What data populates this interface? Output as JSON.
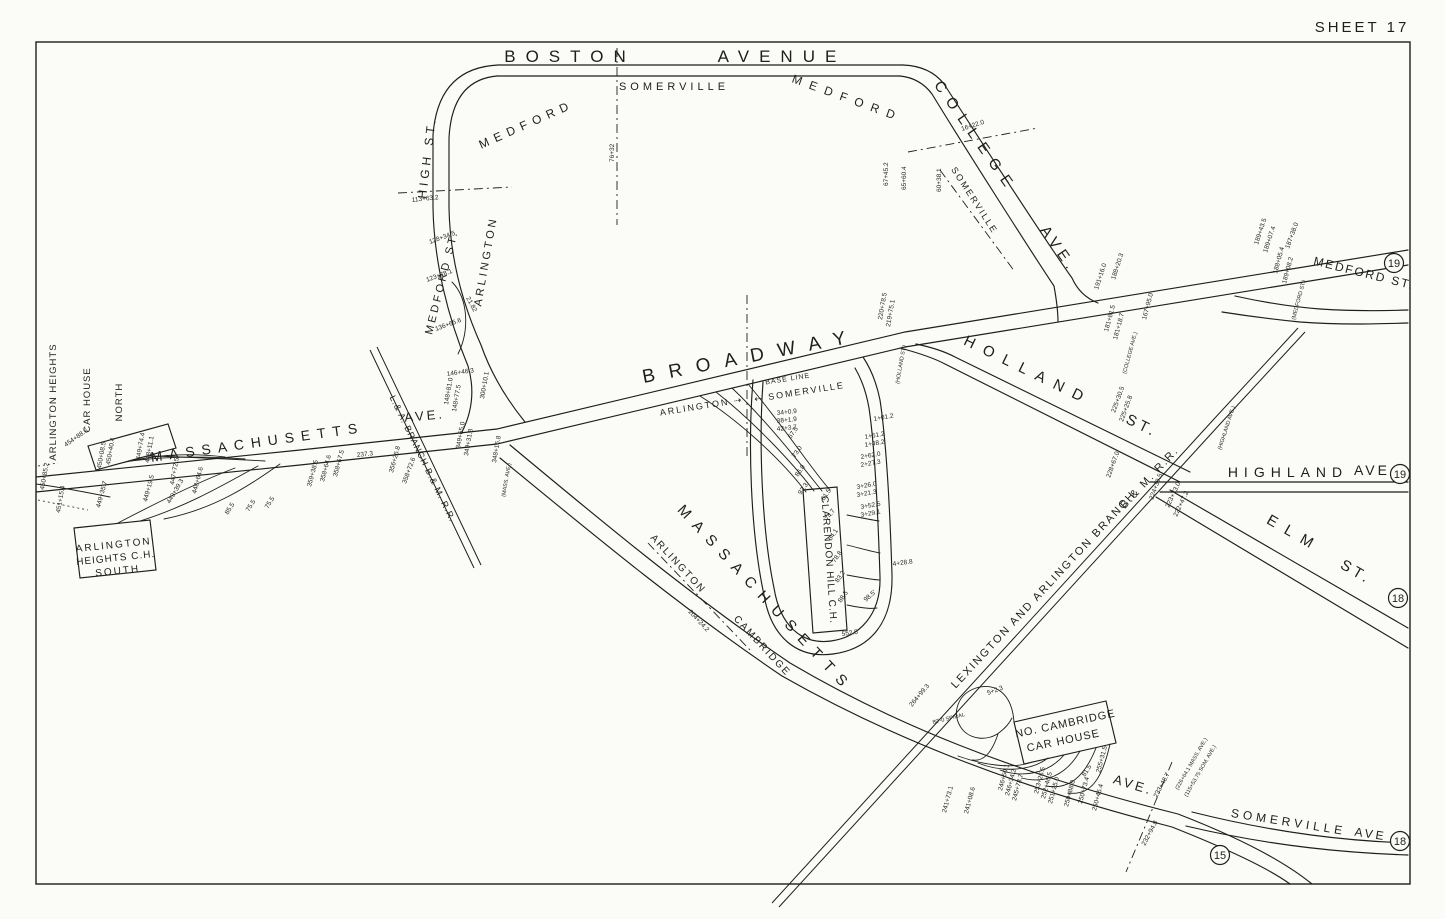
{
  "sheet_title": "SHEET 17",
  "colors": {
    "ink": "#1e1e1e",
    "paper": "#fbfbf8"
  },
  "labels": [
    {
      "n": "street-label-boston",
      "t": "BOSTON",
      "x": 570,
      "y": 62,
      "r": 0,
      "s": 17,
      "ls": 10
    },
    {
      "n": "street-label-avenue",
      "t": "AVENUE",
      "x": 782,
      "y": 62,
      "r": 0,
      "s": 17,
      "ls": 10
    },
    {
      "n": "street-label-college",
      "t": "COLLEGE",
      "x": 972,
      "y": 140,
      "r": 55,
      "s": 15,
      "ls": 9
    },
    {
      "n": "street-label-college-ave",
      "t": "AVE.",
      "x": 1055,
      "y": 252,
      "r": 55,
      "s": 15,
      "ls": 5
    },
    {
      "n": "city-label-medford-west",
      "t": "MEDFORD",
      "x": 528,
      "y": 128,
      "r": -24,
      "s": 12,
      "ls": 6
    },
    {
      "n": "city-label-somerville-top",
      "t": "SOMERVILLE",
      "x": 674,
      "y": 90,
      "r": 0,
      "s": 11,
      "ls": 4
    },
    {
      "n": "city-label-medford-east",
      "t": "MEDFORD",
      "x": 846,
      "y": 102,
      "r": 20,
      "s": 12,
      "ls": 8
    },
    {
      "n": "city-label-somerville-college",
      "t": "SOMERVILLE",
      "x": 972,
      "y": 202,
      "r": 57,
      "s": 9,
      "ls": 2
    },
    {
      "n": "street-label-high-st",
      "t": "HIGH ST.",
      "x": 431,
      "y": 158,
      "r": -83,
      "s": 12,
      "ls": 4
    },
    {
      "n": "street-label-medford-st-arlington",
      "t": "MEDFORD ST.",
      "x": 445,
      "y": 283,
      "r": -76,
      "s": 11,
      "ls": 3
    },
    {
      "n": "city-label-arlington",
      "t": "ARLINGTON",
      "x": 489,
      "y": 262,
      "r": -80,
      "s": 11,
      "ls": 3
    },
    {
      "n": "street-label-broadway",
      "t": "BROADWAY",
      "x": 752,
      "y": 362,
      "r": -11,
      "s": 19,
      "ls": 14
    },
    {
      "n": "boundary-label-arlington",
      "t": "ARLINGTON ⇢",
      "x": 702,
      "y": 409,
      "r": -9,
      "s": 9,
      "ls": 2
    },
    {
      "n": "boundary-label-somerville",
      "t": "⇠ SOMERVILLE",
      "x": 800,
      "y": 395,
      "r": -9,
      "s": 9,
      "ls": 2
    },
    {
      "n": "note-label-base-line",
      "t": "BASE LINE",
      "x": 788,
      "y": 381,
      "r": -9,
      "s": 7,
      "ls": 1
    },
    {
      "n": "street-label-holland",
      "t": "HOLLAND",
      "x": 1026,
      "y": 375,
      "r": 26,
      "s": 15,
      "ls": 10
    },
    {
      "n": "street-label-holland-st",
      "t": "ST.",
      "x": 1140,
      "y": 430,
      "r": 26,
      "s": 15,
      "ls": 4
    },
    {
      "n": "street-label-highland",
      "t": "HIGHLAND",
      "x": 1288,
      "y": 477,
      "r": 0,
      "s": 14,
      "ls": 6
    },
    {
      "n": "street-label-highland-ave",
      "t": "AVE",
      "x": 1372,
      "y": 475,
      "r": 0,
      "s": 14,
      "ls": 3
    },
    {
      "n": "street-label-elm",
      "t": "ELM",
      "x": 1292,
      "y": 538,
      "r": 30,
      "s": 15,
      "ls": 10
    },
    {
      "n": "street-label-elm-st",
      "t": "ST.",
      "x": 1354,
      "y": 576,
      "r": 30,
      "s": 15,
      "ls": 4
    },
    {
      "n": "street-label-medford-st-east",
      "t": "MEDFORD ST.",
      "x": 1363,
      "y": 277,
      "r": 14,
      "s": 12,
      "ls": 2
    },
    {
      "n": "street-label-massachusetts-west",
      "t": "MASSACHUSETTS",
      "x": 258,
      "y": 447,
      "r": -8,
      "s": 14,
      "ls": 7
    },
    {
      "n": "street-label-ave-west",
      "t": "AVE.",
      "x": 425,
      "y": 420,
      "r": -5,
      "s": 13,
      "ls": 3
    },
    {
      "n": "street-label-massachusetts-south",
      "t": "MASSACHUSETTS",
      "x": 762,
      "y": 602,
      "r": 47,
      "s": 15,
      "ls": 9
    },
    {
      "n": "street-label-ave-south",
      "t": "AVE.",
      "x": 1132,
      "y": 789,
      "r": 17,
      "s": 13,
      "ls": 3
    },
    {
      "n": "boundary-label-arlington-south",
      "t": "ARLINGTON",
      "x": 676,
      "y": 566,
      "r": 47,
      "s": 10,
      "ls": 2
    },
    {
      "n": "boundary-label-cambridge",
      "t": "CAMBRIDGE",
      "x": 760,
      "y": 648,
      "r": 47,
      "s": 10,
      "ls": 2
    },
    {
      "n": "street-label-somerville-ave",
      "t": "SOMERVILLE",
      "x": 1288,
      "y": 826,
      "r": 9,
      "s": 12,
      "ls": 4
    },
    {
      "n": "street-label-somerville-ave2",
      "t": "AVE",
      "x": 1370,
      "y": 838,
      "r": 9,
      "s": 12,
      "ls": 3
    },
    {
      "n": "railroad-label-lexington-branch",
      "t": "LEXINGTON AND ARLINGTON BRANCH",
      "x": 1046,
      "y": 592,
      "r": -47,
      "s": 11,
      "ls": 2
    },
    {
      "n": "railroad-label-bm-rr",
      "t": "B.& M. R.R.",
      "x": 1152,
      "y": 480,
      "r": -47,
      "s": 11,
      "ls": 2
    },
    {
      "n": "railroad-label-la-branch",
      "t": "L.& A. BRANCH B.& M. R.R.",
      "x": 420,
      "y": 460,
      "r": 64,
      "s": 9,
      "ls": 1
    },
    {
      "n": "carhouse-label-arlington-heights-north-1",
      "t": "ARLINGTON HEIGHTS",
      "x": 56,
      "y": 402,
      "r": -90,
      "s": 9.5,
      "ls": 1
    },
    {
      "n": "carhouse-label-arlington-heights-north-2",
      "t": "CAR HOUSE",
      "x": 90,
      "y": 400,
      "r": -90,
      "s": 9.5,
      "ls": 1
    },
    {
      "n": "carhouse-label-arlington-heights-north-3",
      "t": "NORTH",
      "x": 122,
      "y": 402,
      "r": -90,
      "s": 9.5,
      "ls": 1
    },
    {
      "n": "carhouse-label-arlington-heights-south-1",
      "t": "ARLINGTON",
      "x": 114,
      "y": 548,
      "r": -6,
      "s": 10,
      "ls": 2
    },
    {
      "n": "carhouse-label-arlington-heights-south-2",
      "t": "HEIGHTS C.H.",
      "x": 116,
      "y": 561,
      "r": -6,
      "s": 10,
      "ls": 1
    },
    {
      "n": "carhouse-label-arlington-heights-south-3",
      "t": "SOUTH",
      "x": 118,
      "y": 574,
      "r": -6,
      "s": 10,
      "ls": 2
    },
    {
      "n": "carhouse-label-clarendon-hill",
      "t": "CLARENDON HILL C.H.",
      "x": 826,
      "y": 560,
      "r": 86,
      "s": 10,
      "ls": 1
    },
    {
      "n": "carhouse-label-no-cambridge-1",
      "t": "NO. CAMBRIDGE",
      "x": 1066,
      "y": 727,
      "r": -12,
      "s": 11,
      "ls": 1
    },
    {
      "n": "carhouse-label-no-cambridge-2",
      "t": "CAR HOUSE",
      "x": 1064,
      "y": 744,
      "r": -12,
      "s": 11,
      "ls": 1
    }
  ],
  "badges": [
    {
      "n": "19",
      "x": 1394,
      "y": 263
    },
    {
      "n": "19",
      "x": 1400,
      "y": 474
    },
    {
      "n": "18",
      "x": 1398,
      "y": 598
    },
    {
      "n": "18",
      "x": 1400,
      "y": 841
    },
    {
      "n": "15",
      "x": 1220,
      "y": 855
    }
  ],
  "annotations": [
    {
      "t": "76+32",
      "x": 614,
      "y": 162,
      "r": -90
    },
    {
      "t": "67+45.2",
      "x": 888,
      "y": 186,
      "r": -90
    },
    {
      "t": "65+60.4",
      "x": 906,
      "y": 190,
      "r": -90
    },
    {
      "t": "60+38.1",
      "x": 941,
      "y": 192,
      "r": -90
    },
    {
      "t": "16+22.0",
      "x": 962,
      "y": 131,
      "r": -18
    },
    {
      "t": "191+16.0",
      "x": 1098,
      "y": 290,
      "r": -72
    },
    {
      "t": "188+20.3",
      "x": 1115,
      "y": 280,
      "r": -72
    },
    {
      "t": "167+95.0",
      "x": 1146,
      "y": 320,
      "r": -75
    },
    {
      "t": "181+81.5",
      "x": 1108,
      "y": 332,
      "r": -75
    },
    {
      "t": "181+18.7",
      "x": 1117,
      "y": 340,
      "r": -75
    },
    {
      "t": "(COLLEGE AVE.)",
      "x": 1126,
      "y": 374,
      "r": -75,
      "s": 5.5
    },
    {
      "t": "189+43.5",
      "x": 1258,
      "y": 245,
      "r": -72
    },
    {
      "t": "189+07.4",
      "x": 1267,
      "y": 253,
      "r": -72
    },
    {
      "t": "187+38.0",
      "x": 1289,
      "y": 249,
      "r": -70
    },
    {
      "t": "188+05.4",
      "x": 1277,
      "y": 274,
      "r": -75
    },
    {
      "t": "189+08.2",
      "x": 1286,
      "y": 284,
      "r": -75
    },
    {
      "t": "(MEDFORD ST.)",
      "x": 1295,
      "y": 320,
      "r": -75,
      "s": 5.5
    },
    {
      "t": "225+30.5",
      "x": 1115,
      "y": 413,
      "r": -70
    },
    {
      "t": "225+25.8",
      "x": 1123,
      "y": 422,
      "r": -70
    },
    {
      "t": "(HIGHLAND AVE.)",
      "x": 1221,
      "y": 450,
      "r": -72,
      "s": 5.5
    },
    {
      "t": "228+67.0",
      "x": 1110,
      "y": 478,
      "r": -70
    },
    {
      "t": "224+39.5",
      "x": 1153,
      "y": 500,
      "r": -70
    },
    {
      "t": "223+73.0",
      "x": 1169,
      "y": 508,
      "r": -65
    },
    {
      "t": "222+47.2",
      "x": 1177,
      "y": 517,
      "r": -65
    },
    {
      "t": "220+78.5",
      "x": 882,
      "y": 320,
      "r": -80
    },
    {
      "t": "219+75.1",
      "x": 890,
      "y": 327,
      "r": -80
    },
    {
      "t": "(HOLLAND ST.)",
      "x": 899,
      "y": 384,
      "r": -80,
      "s": 5.5
    },
    {
      "t": "1+01.2",
      "x": 874,
      "y": 421,
      "r": -10
    },
    {
      "t": "1+61.2",
      "x": 865,
      "y": 439,
      "r": -10
    },
    {
      "t": "1+48.2",
      "x": 865,
      "y": 447,
      "r": -10
    },
    {
      "t": "2+62.0",
      "x": 861,
      "y": 459,
      "r": -10
    },
    {
      "t": "2+27.3",
      "x": 861,
      "y": 467,
      "r": -10
    },
    {
      "t": "3+26.0",
      "x": 857,
      "y": 489,
      "r": -10
    },
    {
      "t": "3+21.3",
      "x": 857,
      "y": 497,
      "r": -10
    },
    {
      "t": "3+52.5",
      "x": 861,
      "y": 509,
      "r": -10
    },
    {
      "t": "3+29.1",
      "x": 861,
      "y": 517,
      "r": -10
    },
    {
      "t": "4+28.8",
      "x": 893,
      "y": 566,
      "r": -8
    },
    {
      "t": "98.5'",
      "x": 866,
      "y": 602,
      "r": -42
    },
    {
      "t": "552.5",
      "x": 842,
      "y": 636,
      "r": -8
    },
    {
      "t": "34+0.9",
      "x": 777,
      "y": 415,
      "r": -6
    },
    {
      "t": "38+1.9",
      "x": 777,
      "y": 423,
      "r": -6
    },
    {
      "t": "42+3.7",
      "x": 777,
      "y": 431,
      "r": -6
    },
    {
      "t": "67.5",
      "x": 791,
      "y": 439,
      "r": -55
    },
    {
      "t": "73.0",
      "x": 795,
      "y": 458,
      "r": -55
    },
    {
      "t": "86.0",
      "x": 798,
      "y": 477,
      "r": -55
    },
    {
      "t": "97.3",
      "x": 801,
      "y": 495,
      "r": -55
    },
    {
      "t": "61.5",
      "x": 824,
      "y": 501,
      "r": -55
    },
    {
      "t": "74.7",
      "x": 828,
      "y": 521,
      "r": -55
    },
    {
      "t": "64.1",
      "x": 831,
      "y": 541,
      "r": -55
    },
    {
      "t": "78.8",
      "x": 835,
      "y": 563,
      "r": -55
    },
    {
      "t": "83.2",
      "x": 838,
      "y": 583,
      "r": -55
    },
    {
      "t": "88.5",
      "x": 841,
      "y": 603,
      "r": -55
    },
    {
      "t": "146+46.3",
      "x": 447,
      "y": 376,
      "r": -8
    },
    {
      "t": "148+81.0",
      "x": 448,
      "y": 405,
      "r": -80
    },
    {
      "t": "148+77.5",
      "x": 456,
      "y": 412,
      "r": -80
    },
    {
      "t": "300+10.1",
      "x": 484,
      "y": 399,
      "r": -80
    },
    {
      "t": "349+65.0",
      "x": 460,
      "y": 449,
      "r": -80
    },
    {
      "t": "349+31.8",
      "x": 468,
      "y": 456,
      "r": -80
    },
    {
      "t": "348+16.8",
      "x": 496,
      "y": 463,
      "r": -80
    },
    {
      "t": "(MASS. AVE.)",
      "x": 505,
      "y": 497,
      "r": -80,
      "s": 5.5
    },
    {
      "t": "449+35.7",
      "x": 100,
      "y": 508,
      "r": -75
    },
    {
      "t": "449+19.5",
      "x": 147,
      "y": 502,
      "r": -75
    },
    {
      "t": "448+64.6",
      "x": 196,
      "y": 494,
      "r": -75
    },
    {
      "t": "359+38.5",
      "x": 311,
      "y": 487,
      "r": -75
    },
    {
      "t": "358+64.6",
      "x": 324,
      "y": 482,
      "r": -75
    },
    {
      "t": "358+67.5",
      "x": 337,
      "y": 477,
      "r": -75
    },
    {
      "t": "356+26.8",
      "x": 393,
      "y": 473,
      "r": -75
    },
    {
      "t": "358+72.6",
      "x": 406,
      "y": 484,
      "r": -70
    },
    {
      "t": "237.3",
      "x": 357,
      "y": 457,
      "r": -6
    },
    {
      "t": "454+88.6",
      "x": 66,
      "y": 447,
      "r": -35
    },
    {
      "t": "450+40.4",
      "x": 110,
      "y": 465,
      "r": -80
    },
    {
      "t": "450+08.5",
      "x": 101,
      "y": 469,
      "r": -80
    },
    {
      "t": "449+74.4",
      "x": 140,
      "y": 460,
      "r": -80
    },
    {
      "t": "448+11.1",
      "x": 149,
      "y": 463,
      "r": -80
    },
    {
      "t": "447+72.5",
      "x": 174,
      "y": 485,
      "r": -80
    },
    {
      "t": "449+39.3",
      "x": 170,
      "y": 504,
      "r": -60
    },
    {
      "t": "450+85.2",
      "x": 44,
      "y": 490,
      "r": -80
    },
    {
      "t": "451+15.4",
      "x": 60,
      "y": 513,
      "r": -80
    },
    {
      "t": "85.5",
      "x": 228,
      "y": 515,
      "r": -58
    },
    {
      "t": "75.5",
      "x": 249,
      "y": 512,
      "r": -58
    },
    {
      "t": "75.5",
      "x": 268,
      "y": 509,
      "r": -58
    },
    {
      "t": "113+63.2",
      "x": 412,
      "y": 202,
      "r": -6
    },
    {
      "t": "128+34.5",
      "x": 430,
      "y": 244,
      "r": -20
    },
    {
      "t": "123+78.1",
      "x": 427,
      "y": 282,
      "r": -20
    },
    {
      "t": "136+65.6",
      "x": 436,
      "y": 331,
      "r": -20
    },
    {
      "t": "21.82",
      "x": 466,
      "y": 298,
      "r": 62
    },
    {
      "t": "204+24.2",
      "x": 688,
      "y": 612,
      "r": 47
    },
    {
      "t": "264+99.3",
      "x": 912,
      "y": 707,
      "r": -50
    },
    {
      "t": "5+2.3",
      "x": 988,
      "y": 695,
      "r": -20
    },
    {
      "t": "80'-0 SPIRAL",
      "x": 933,
      "y": 724,
      "r": -14,
      "s": 5.5
    },
    {
      "t": "241+73.1",
      "x": 946,
      "y": 813,
      "r": -75
    },
    {
      "t": "241+08.6",
      "x": 968,
      "y": 814,
      "r": -75
    },
    {
      "t": "246+50.1",
      "x": 1002,
      "y": 791,
      "r": -75
    },
    {
      "t": "246+34.2",
      "x": 1009,
      "y": 796,
      "r": -75
    },
    {
      "t": "245+78.7",
      "x": 1016,
      "y": 801,
      "r": -75
    },
    {
      "t": "253+26.5",
      "x": 1038,
      "y": 794,
      "r": -75
    },
    {
      "t": "252+46.5",
      "x": 1045,
      "y": 799,
      "r": -75
    },
    {
      "t": "251+25.0",
      "x": 1052,
      "y": 804,
      "r": -75
    },
    {
      "t": "250+88.0",
      "x": 1068,
      "y": 807,
      "r": -75
    },
    {
      "t": "250+73.4",
      "x": 1082,
      "y": 804,
      "r": -75
    },
    {
      "t": "250+45.4",
      "x": 1096,
      "y": 811,
      "r": -75
    },
    {
      "t": "255+31.5",
      "x": 1100,
      "y": 773,
      "r": -75
    },
    {
      "t": "81.5",
      "x": 1085,
      "y": 777,
      "r": -58
    },
    {
      "t": "233+48.7",
      "x": 1157,
      "y": 798,
      "r": -62
    },
    {
      "t": "232+94.8",
      "x": 1145,
      "y": 846,
      "r": -62
    },
    {
      "t": "(226+64.1 MASS. AVE.)",
      "x": 1178,
      "y": 790,
      "r": -60,
      "s": 5.5
    },
    {
      "t": "(115+53.75 SOM. AVE.)",
      "x": 1187,
      "y": 797,
      "r": -60,
      "s": 5.5
    }
  ]
}
